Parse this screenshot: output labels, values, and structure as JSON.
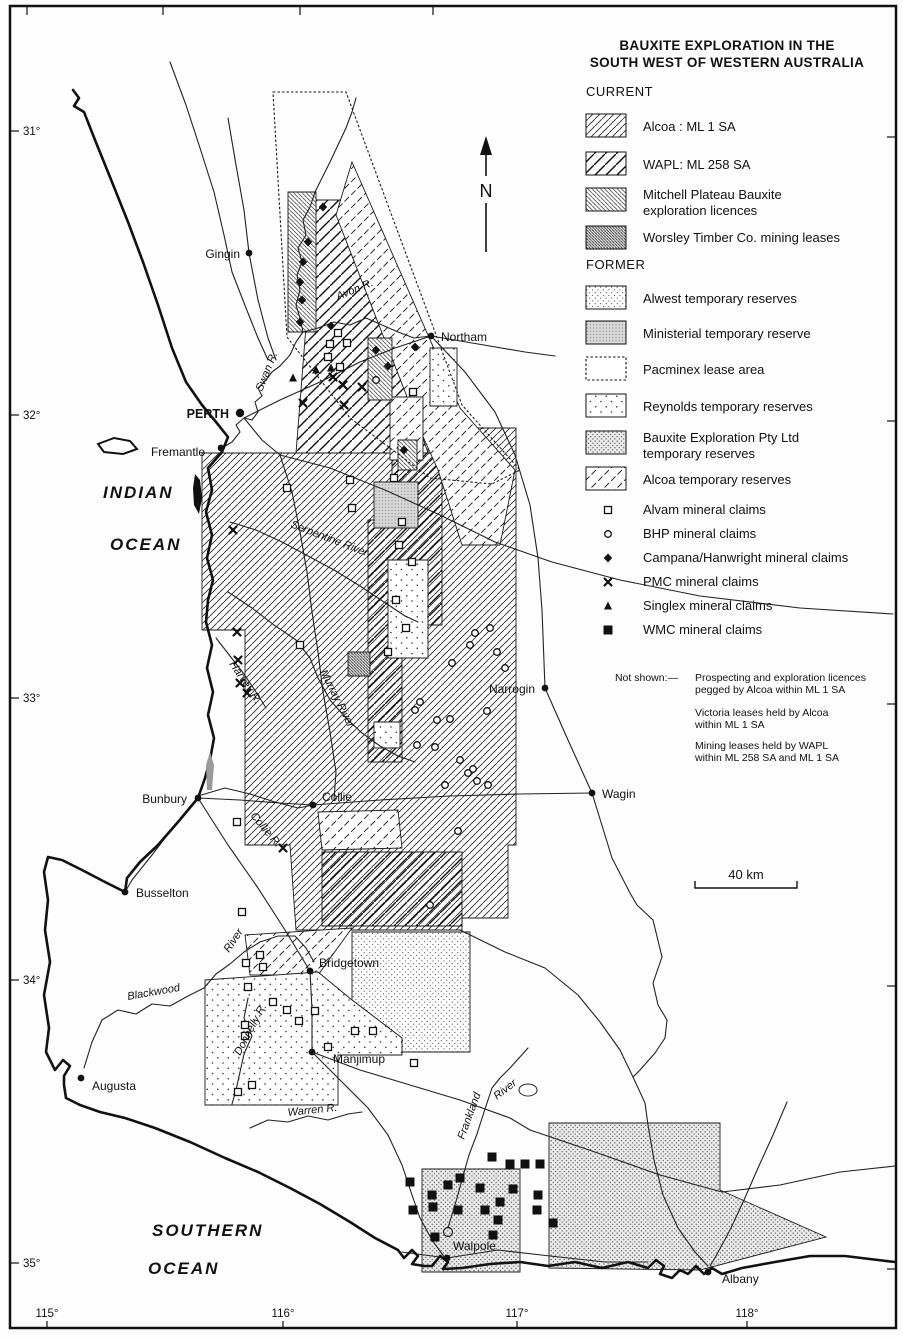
{
  "title": {
    "line1": "BAUXITE EXPLORATION IN THE",
    "line2": "SOUTH WEST OF WESTERN AUSTRALIA"
  },
  "legend": {
    "sections": [
      {
        "heading": "CURRENT",
        "heading_y": 96,
        "items": [
          {
            "pattern": "p-ml1",
            "swatch_y": 114,
            "lines": [
              "Alcoa : ML 1 SA"
            ],
            "line_ys": [
              131
            ]
          },
          {
            "pattern": "p-ml258",
            "swatch_y": 152,
            "lines": [
              "WAPL: ML 258 SA"
            ],
            "line_ys": [
              169
            ]
          },
          {
            "pattern": "p-mitchell",
            "swatch_y": 188,
            "lines": [
              "Mitchell Plateau Bauxite",
              "exploration licences"
            ],
            "line_ys": [
              199,
              215
            ]
          },
          {
            "pattern": "p-worsley",
            "swatch_y": 226,
            "lines": [
              "Worsley Timber Co. mining leases"
            ],
            "line_ys": [
              242
            ]
          }
        ]
      },
      {
        "heading": "FORMER",
        "heading_y": 269,
        "items": [
          {
            "pattern": "p-alwest",
            "swatch_y": 286,
            "lines": [
              "Alwest temporary reserves"
            ],
            "line_ys": [
              303
            ]
          },
          {
            "pattern": "p-ministerial",
            "swatch_y": 321,
            "lines": [
              "Ministerial temporary reserve"
            ],
            "line_ys": [
              338
            ]
          },
          {
            "pattern": "p-pacminex",
            "swatch_y": 357,
            "lines": [
              "Pacminex  lease area"
            ],
            "line_ys": [
              374
            ]
          },
          {
            "pattern": "p-reynolds",
            "swatch_y": 394,
            "lines": [
              "Reynolds temporary reserves"
            ],
            "line_ys": [
              411
            ]
          },
          {
            "pattern": "p-bepl",
            "swatch_y": 431,
            "lines": [
              "Bauxite Exploration Pty Ltd",
              "temporary reserves"
            ],
            "line_ys": [
              442,
              458
            ]
          },
          {
            "pattern": "p-alcoatemp",
            "swatch_y": 467,
            "lines": [
              "Alcoa temporary reserves"
            ],
            "line_ys": [
              484
            ]
          }
        ]
      }
    ],
    "claims": [
      {
        "symbol": "alvam",
        "label": "Alvam mineral claims",
        "y": 514
      },
      {
        "symbol": "bhp",
        "label": "BHP mineral claims",
        "y": 538
      },
      {
        "symbol": "campana",
        "label": "Campana/Hanwright mineral claims",
        "y": 562
      },
      {
        "symbol": "pmc",
        "label": "PMC mineral claims",
        "y": 586
      },
      {
        "symbol": "singlex",
        "label": "Singlex mineral claims",
        "y": 610
      },
      {
        "symbol": "wmc",
        "label": "WMC mineral claims",
        "y": 634
      }
    ],
    "not_shown": {
      "label": "Not shown:—",
      "notes": [
        {
          "lines": [
            "Prospecting and exploration licences",
            "pegged by Alcoa within ML 1 SA"
          ],
          "ys": [
            681,
            693
          ]
        },
        {
          "lines": [
            "Victoria leases held by Alcoa",
            "within ML 1 SA"
          ],
          "ys": [
            716,
            728
          ]
        },
        {
          "lines": [
            "Mining leases held by WAPL",
            "within ML 258 SA and ML 1 SA"
          ],
          "ys": [
            749,
            761
          ]
        }
      ]
    }
  },
  "north_arrow": {
    "label": "N"
  },
  "scale_bar": {
    "label": "40 km"
  },
  "graticule": {
    "lat": [
      {
        "label": "31°",
        "y": 131
      },
      {
        "label": "32°",
        "y": 415
      },
      {
        "label": "33°",
        "y": 698
      },
      {
        "label": "34°",
        "y": 980
      },
      {
        "label": "35°",
        "y": 1263
      }
    ],
    "lon": [
      {
        "label": "115°",
        "x": 47
      },
      {
        "label": "116°",
        "x": 283
      },
      {
        "label": "117°",
        "x": 517
      },
      {
        "label": "118°",
        "x": 747
      }
    ],
    "top_ticks": [
      27,
      163,
      300,
      433
    ]
  },
  "oceans": [
    {
      "label": "INDIAN",
      "x": 103,
      "y": 498
    },
    {
      "label": "OCEAN",
      "x": 110,
      "y": 550
    },
    {
      "label": "SOUTHERN",
      "x": 152,
      "y": 1236
    },
    {
      "label": "OCEAN",
      "x": 148,
      "y": 1274
    }
  ],
  "towns": [
    {
      "name": "Gingin",
      "x": 249,
      "y": 253,
      "lx": 240,
      "ly": 258,
      "anchor": "end"
    },
    {
      "name": "Northam",
      "x": 431,
      "y": 336,
      "lx": 441,
      "ly": 341,
      "anchor": "start"
    },
    {
      "name": "PERTH",
      "x": 240,
      "y": 413,
      "lx": 229,
      "ly": 418,
      "anchor": "end",
      "bold": true
    },
    {
      "name": "Fremantle",
      "x": 221,
      "y": 448,
      "lx": 205,
      "ly": 456,
      "anchor": "end"
    },
    {
      "name": "Narrogin",
      "x": 545,
      "y": 688,
      "lx": 535,
      "ly": 693,
      "anchor": "end"
    },
    {
      "name": "Wagin",
      "x": 592,
      "y": 793,
      "lx": 602,
      "ly": 798,
      "anchor": "start"
    },
    {
      "name": "Bunbury",
      "x": 198,
      "y": 798,
      "lx": 187,
      "ly": 803,
      "anchor": "end"
    },
    {
      "name": "Collie",
      "x": 313,
      "y": 805,
      "lx": 322,
      "ly": 801,
      "anchor": "start"
    },
    {
      "name": "Busselton",
      "x": 125,
      "y": 892,
      "lx": 136,
      "ly": 897,
      "anchor": "start"
    },
    {
      "name": "Bridgetown",
      "x": 310,
      "y": 971,
      "lx": 319,
      "ly": 967,
      "anchor": "start"
    },
    {
      "name": "Manjimup",
      "x": 312,
      "y": 1052,
      "lx": 333,
      "ly": 1063,
      "anchor": "start"
    },
    {
      "name": "Augusta",
      "x": 81,
      "y": 1078,
      "lx": 92,
      "ly": 1090,
      "anchor": "start"
    },
    {
      "name": "Walpole",
      "x": 447,
      "y": 1258,
      "lx": 453,
      "ly": 1250,
      "anchor": "start"
    },
    {
      "name": "Albany",
      "x": 708,
      "y": 1272,
      "lx": 722,
      "ly": 1283,
      "anchor": "start"
    }
  ],
  "rivers": [
    {
      "label": "Swan R.",
      "x": 262,
      "y": 392,
      "rot": -68
    },
    {
      "label": "Avon R.",
      "x": 338,
      "y": 300,
      "rot": -22
    },
    {
      "label": "Serpentine River",
      "x": 290,
      "y": 527,
      "rot": 21
    },
    {
      "label": "Murray River",
      "x": 320,
      "y": 672,
      "rot": 63
    },
    {
      "label": "Harvey R.",
      "x": 229,
      "y": 664,
      "rot": 56
    },
    {
      "label": "Collie R.",
      "x": 250,
      "y": 816,
      "rot": 50
    },
    {
      "label": "Blackwood",
      "x": 128,
      "y": 1000,
      "rot": -10
    },
    {
      "label": "River",
      "x": 229,
      "y": 953,
      "rot": -56
    },
    {
      "label": "Donnelly R.",
      "x": 240,
      "y": 1056,
      "rot": -62
    },
    {
      "label": "Warren R.",
      "x": 288,
      "y": 1116,
      "rot": -6
    },
    {
      "label": "Frankland",
      "x": 464,
      "y": 1140,
      "rot": -70
    },
    {
      "label": "River",
      "x": 497,
      "y": 1100,
      "rot": -38
    }
  ],
  "claims_points": {
    "alvam": [
      [
        338,
        333
      ],
      [
        330,
        344
      ],
      [
        347,
        343
      ],
      [
        328,
        357
      ],
      [
        340,
        367
      ],
      [
        413,
        392
      ],
      [
        287,
        488
      ],
      [
        350,
        480
      ],
      [
        352,
        508
      ],
      [
        394,
        478
      ],
      [
        402,
        522
      ],
      [
        399,
        545
      ],
      [
        412,
        562
      ],
      [
        396,
        600
      ],
      [
        406,
        628
      ],
      [
        388,
        652
      ],
      [
        300,
        645
      ],
      [
        237,
        822
      ],
      [
        242,
        912
      ],
      [
        260,
        955
      ],
      [
        246,
        963
      ],
      [
        263,
        967
      ],
      [
        248,
        987
      ],
      [
        273,
        1002
      ],
      [
        287,
        1010
      ],
      [
        299,
        1021
      ],
      [
        315,
        1011
      ],
      [
        245,
        1025
      ],
      [
        245,
        1036
      ],
      [
        355,
        1031
      ],
      [
        373,
        1031
      ],
      [
        328,
        1047
      ],
      [
        252,
        1085
      ],
      [
        238,
        1092
      ],
      [
        414,
        1063
      ]
    ],
    "bhp": [
      [
        376,
        380
      ],
      [
        475,
        633
      ],
      [
        490,
        628
      ],
      [
        470,
        645
      ],
      [
        497,
        652
      ],
      [
        452,
        663
      ],
      [
        505,
        668
      ],
      [
        420,
        702
      ],
      [
        415,
        710
      ],
      [
        437,
        720
      ],
      [
        450,
        719
      ],
      [
        487,
        711
      ],
      [
        417,
        745
      ],
      [
        435,
        747
      ],
      [
        460,
        760
      ],
      [
        468,
        773
      ],
      [
        473,
        769
      ],
      [
        488,
        785
      ],
      [
        445,
        785
      ],
      [
        477,
        781
      ],
      [
        458,
        831
      ],
      [
        430,
        905
      ]
    ],
    "campana": [
      [
        323,
        207
      ],
      [
        308,
        242
      ],
      [
        303,
        262
      ],
      [
        300,
        282
      ],
      [
        302,
        300
      ],
      [
        300,
        322
      ],
      [
        331,
        326
      ],
      [
        376,
        350
      ],
      [
        388,
        366
      ],
      [
        415,
        347
      ],
      [
        404,
        450
      ]
    ],
    "pmc": [
      [
        333,
        377
      ],
      [
        343,
        385
      ],
      [
        362,
        387
      ],
      [
        303,
        403
      ],
      [
        344,
        405
      ],
      [
        233,
        530
      ],
      [
        237,
        632
      ],
      [
        238,
        660
      ],
      [
        240,
        683
      ],
      [
        247,
        693
      ],
      [
        283,
        848
      ]
    ],
    "singlex": [
      [
        293,
        378
      ],
      [
        316,
        370
      ],
      [
        331,
        368
      ]
    ],
    "wmc": [
      [
        492,
        1157
      ],
      [
        510,
        1164
      ],
      [
        525,
        1164
      ],
      [
        540,
        1164
      ],
      [
        410,
        1182
      ],
      [
        448,
        1185
      ],
      [
        460,
        1178
      ],
      [
        480,
        1188
      ],
      [
        513,
        1189
      ],
      [
        432,
        1195
      ],
      [
        413,
        1210
      ],
      [
        433,
        1207
      ],
      [
        458,
        1210
      ],
      [
        485,
        1210
      ],
      [
        500,
        1202
      ],
      [
        538,
        1195
      ],
      [
        537,
        1210
      ],
      [
        498,
        1220
      ],
      [
        553,
        1223
      ],
      [
        435,
        1237
      ],
      [
        493,
        1235
      ]
    ]
  }
}
